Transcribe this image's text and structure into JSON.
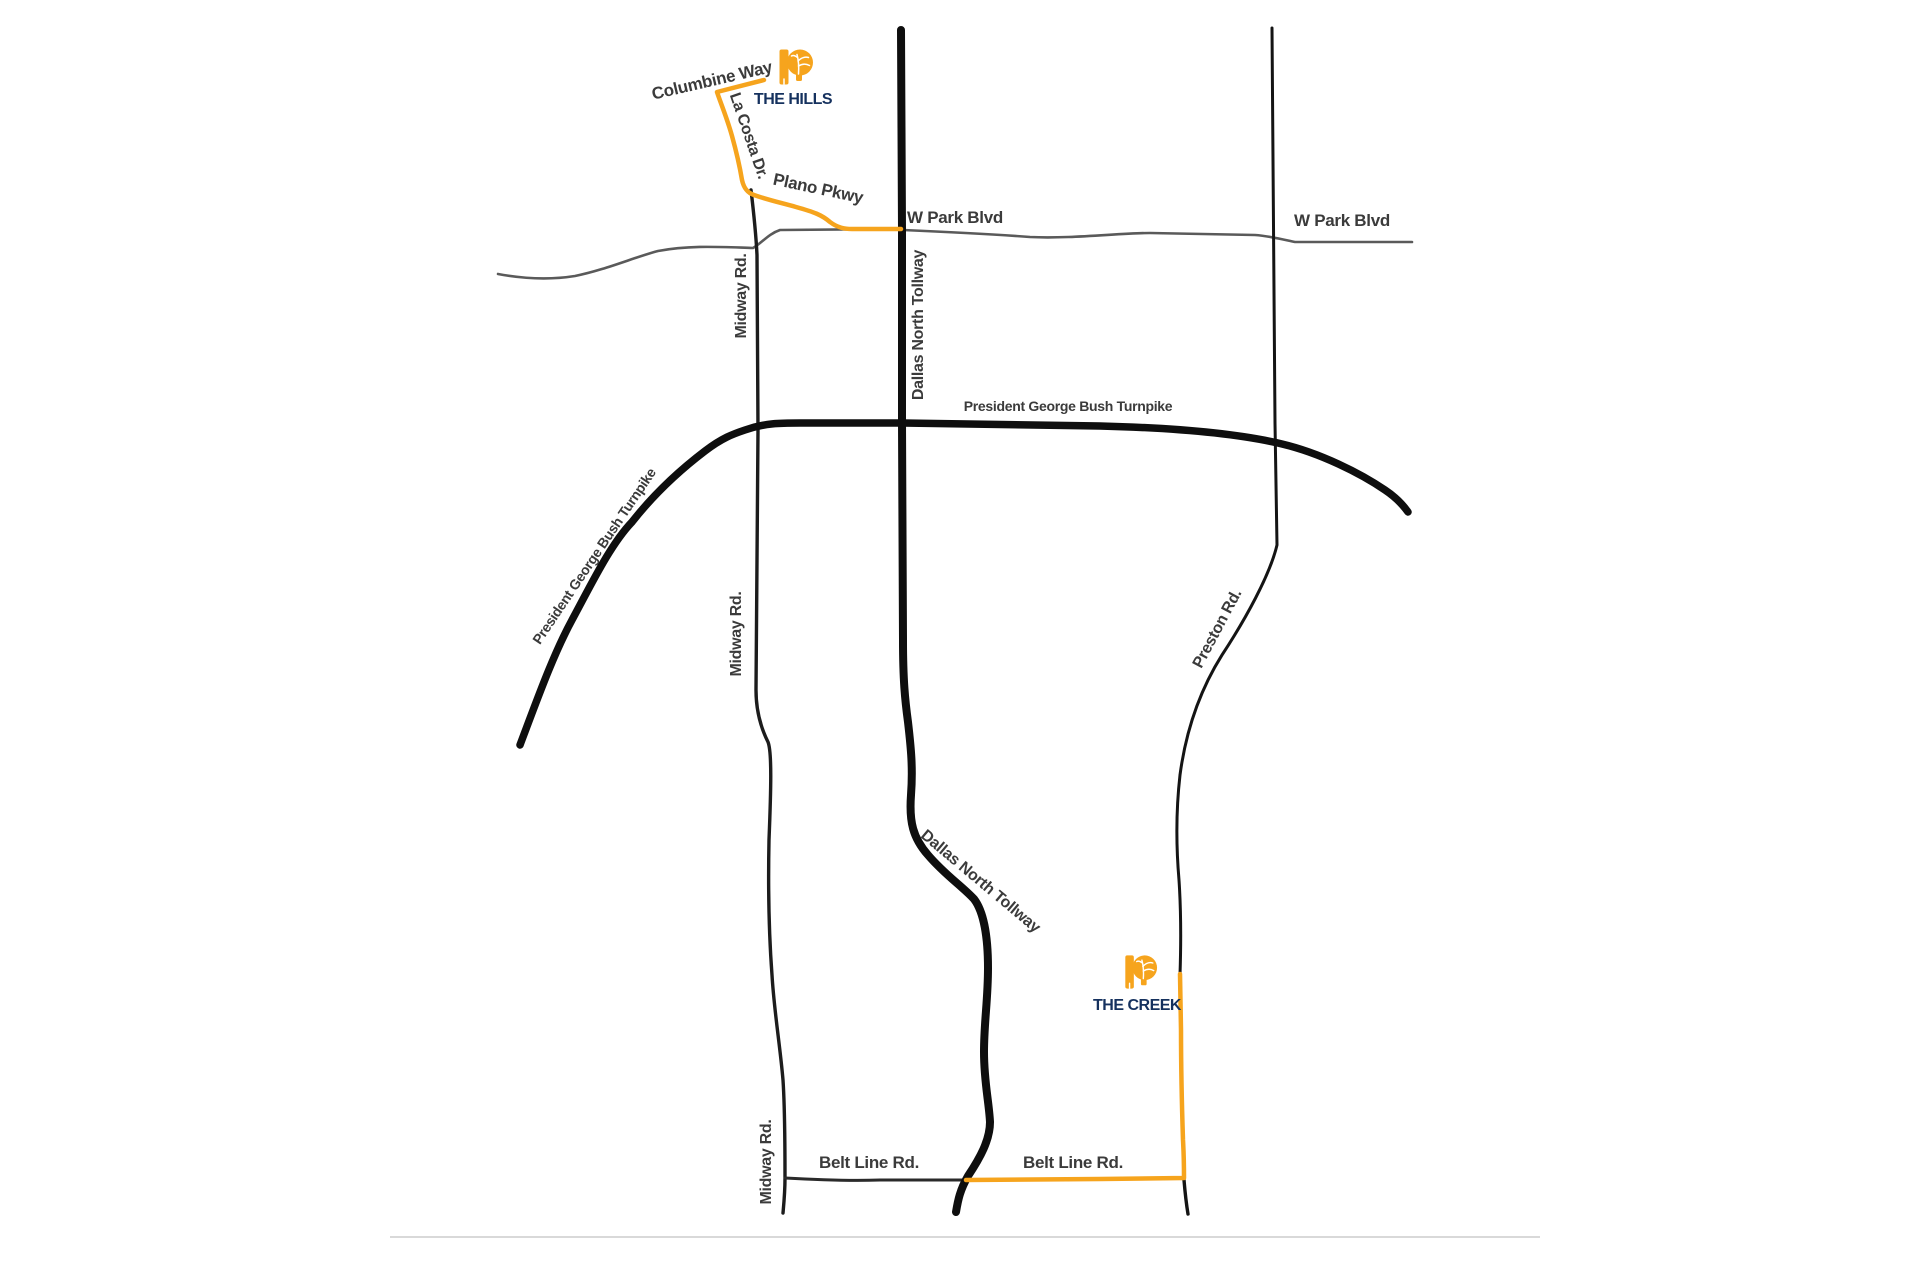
{
  "map": {
    "locations": [
      {
        "id": "the-hills",
        "label": "THE HILLS"
      },
      {
        "id": "the-creek",
        "label": "THE CREEK"
      }
    ],
    "road_labels": {
      "columbine_way": "Columbine Way",
      "la_costa_dr": "La Costa Dr.",
      "plano_pkwy": "Plano Pkwy",
      "w_park_blvd_west": "W Park Blvd",
      "w_park_blvd_east": "W Park Blvd",
      "midway_rd_north": "Midway Rd.",
      "midway_rd_mid": "Midway Rd.",
      "midway_rd_south": "Midway Rd.",
      "dallas_north_tollway_north": "Dallas North Tollway",
      "dallas_north_tollway_south": "Dallas North Tollway",
      "pgbt_diagonal": "President George Bush Turnpike",
      "pgbt_horizontal": "President George Bush Turnpike",
      "preston_rd": "Preston Rd.",
      "belt_line_rd_west": "Belt Line Rd.",
      "belt_line_rd_east": "Belt Line Rd."
    },
    "colors": {
      "highlight_route": "#F6A41D",
      "major_road": "#0e0e0e",
      "minor_road": "#4a4a4a",
      "road_label": "#3b3b3b",
      "location_label": "#15315E",
      "logo_orange": "#F6A41D"
    }
  }
}
